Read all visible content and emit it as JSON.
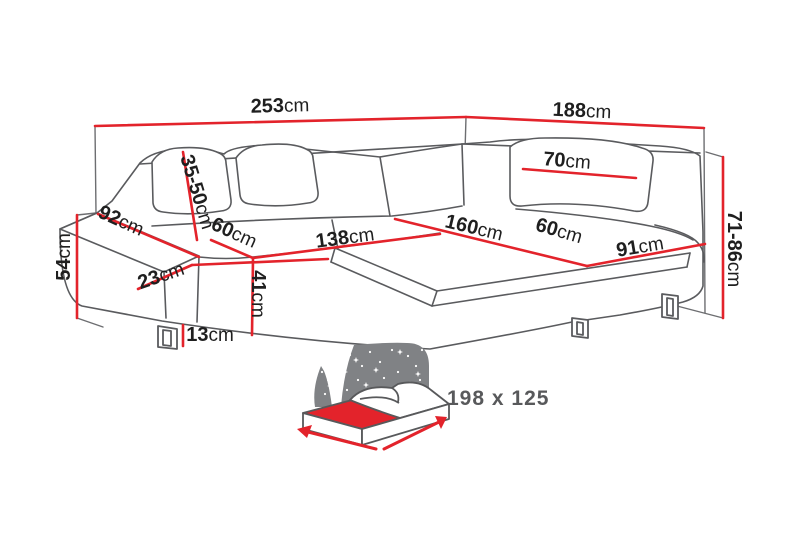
{
  "diagram": {
    "type": "corner-sofa-dimension-drawing",
    "unit": "cm",
    "colors": {
      "dimension_red": "#e3232b",
      "drawing_gray": "#5a5b5e",
      "frame_gray": "#6d6e71",
      "label_black": "#1f1f1f",
      "bed_icon_gray": "#808285",
      "bed_text_gray": "#58595b"
    },
    "dimensions": [
      {
        "id": "dim-253",
        "value": "253",
        "unit": "cm"
      },
      {
        "id": "dim-188",
        "value": "188",
        "unit": "cm"
      },
      {
        "id": "dim-92",
        "value": "92",
        "unit": "cm"
      },
      {
        "id": "dim-35-50",
        "value": "35-50",
        "unit": "cm"
      },
      {
        "id": "dim-60-left",
        "value": "60",
        "unit": "cm"
      },
      {
        "id": "dim-138",
        "value": "138",
        "unit": "cm"
      },
      {
        "id": "dim-70",
        "value": "70",
        "unit": "cm"
      },
      {
        "id": "dim-160",
        "value": "160",
        "unit": "cm"
      },
      {
        "id": "dim-60-right",
        "value": "60",
        "unit": "cm"
      },
      {
        "id": "dim-91",
        "value": "91",
        "unit": "cm"
      },
      {
        "id": "dim-71-86",
        "value": "71-86",
        "unit": "cm"
      },
      {
        "id": "dim-54",
        "value": "54",
        "unit": "cm"
      },
      {
        "id": "dim-23",
        "value": "23",
        "unit": "cm"
      },
      {
        "id": "dim-41",
        "value": "41",
        "unit": "cm"
      },
      {
        "id": "dim-13",
        "value": "13",
        "unit": "cm"
      }
    ],
    "sleeping_area": {
      "label": "198 x 125"
    }
  }
}
